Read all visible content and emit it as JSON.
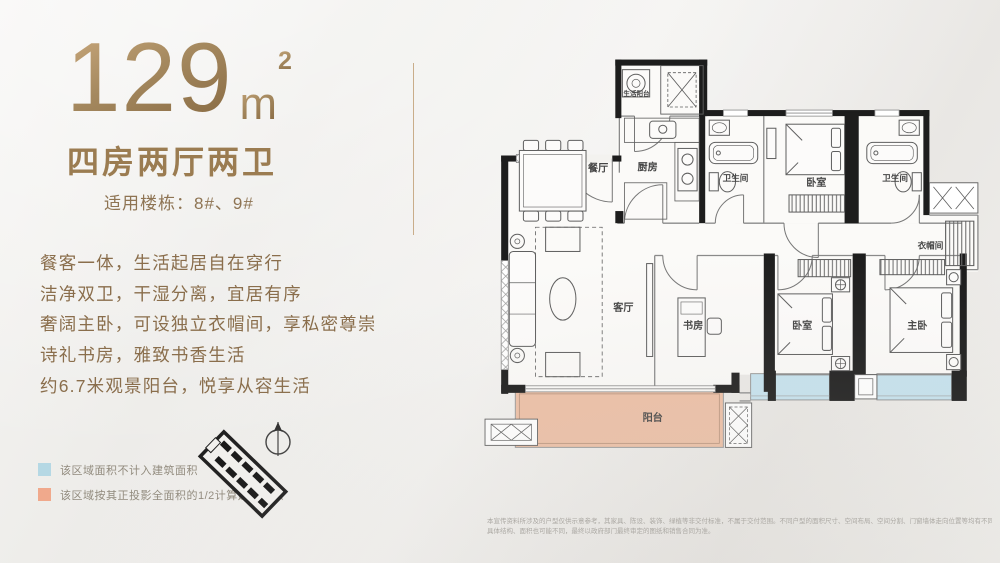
{
  "header": {
    "area_value": "129",
    "area_unit": "m",
    "area_sup": "2",
    "layout_type": "四房两厅两卫",
    "buildings": "适用楼栋：8#、9#"
  },
  "features": [
    "餐客一体，生活起居自在穿行",
    "洁净双卫，干湿分离，宜居有序",
    "奢阔主卧，可设独立衣帽间，享私密尊崇",
    "诗礼书房，雅致书香生活",
    "约6.7米观景阳台，悦享从容生活"
  ],
  "legend": {
    "items": [
      {
        "color": "#b5d8e4",
        "label": "该区域面积不计入建筑面积"
      },
      {
        "color": "#f0a98c",
        "label": "该区域按其正投影全面积的1/2计算建筑面积"
      }
    ]
  },
  "floorplan": {
    "rooms": [
      {
        "key": "dining",
        "label": "餐厅"
      },
      {
        "key": "kitchen",
        "label": "厨房"
      },
      {
        "key": "service-balcony",
        "label": "生活阳台"
      },
      {
        "key": "bath-a",
        "label": "卫生间"
      },
      {
        "key": "bedroom-top",
        "label": "卧室"
      },
      {
        "key": "bath-b",
        "label": "卫生间"
      },
      {
        "key": "cloakroom",
        "label": "衣帽间"
      },
      {
        "key": "living",
        "label": "客厅"
      },
      {
        "key": "study",
        "label": "书房"
      },
      {
        "key": "bedroom-bottom",
        "label": "卧室"
      },
      {
        "key": "master",
        "label": "主卧"
      },
      {
        "key": "balcony",
        "label": "阳台"
      }
    ]
  },
  "disclaimer": [
    "本宣传资料所涉及的户型仅供示意参考，其家具、陈设、装饰、绿植等非交付标准，不属于交付范围。不同户型的面积尺寸、空间布局、空间分割、门窗墙体走向位置等均有不同，相邻户型因遮挡、结构、管道等原因视觉效果不同，",
    "具体结构、面积也可能不同，最终以政府部门最终审定的图纸和销售合同为准。"
  ],
  "colors": {
    "accent_gold": "#a3855c",
    "balcony_fill": "#edc0a6",
    "bay_window_blue": "#c6e2ee",
    "wall_black": "#1d1d1d"
  }
}
